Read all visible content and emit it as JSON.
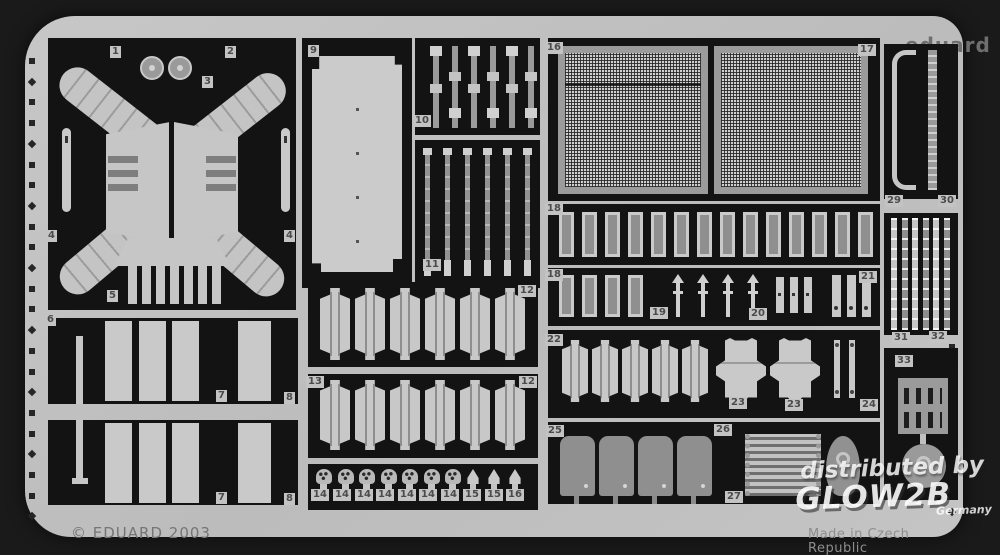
{
  "header": {
    "title": "35 560 BMP-2 part1",
    "brand": "eduard"
  },
  "footer": {
    "copyright": "© EDUARD 2003",
    "made_in": "Made in Czech Republic"
  },
  "watermark": {
    "line1": "distributed by",
    "brand": "GLOW2B",
    "country": "Germany"
  },
  "colors": {
    "background": "#1a1a1a",
    "sheet": "#c2c2c2",
    "cutout": "#131313",
    "part_light": "#c8c8c8",
    "part_mid": "#9a9a9a"
  },
  "labels": [
    "1",
    "2",
    "3",
    "4",
    "4",
    "5",
    "6",
    "7",
    "8",
    "7",
    "8",
    "9",
    "10",
    "11",
    "12",
    "13",
    "12",
    "14",
    "14",
    "14",
    "14",
    "14",
    "14",
    "14",
    "15",
    "15",
    "16",
    "16",
    "17",
    "18",
    "18",
    "19",
    "20",
    "21",
    "22",
    "23",
    "23",
    "24",
    "25",
    "26",
    "27",
    "29",
    "30",
    "31",
    "32",
    "33"
  ]
}
